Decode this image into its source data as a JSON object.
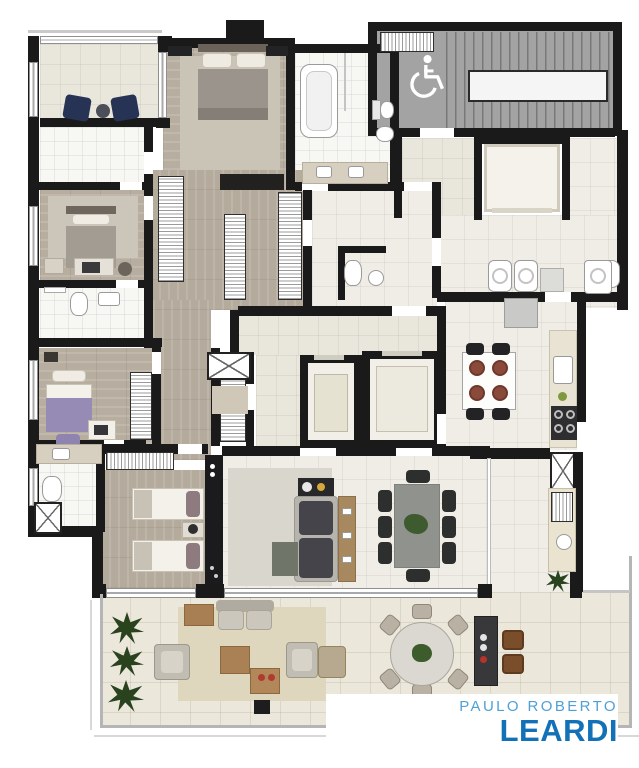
{
  "brand": {
    "name_line1": "PAULO ROBERTO",
    "name_line2": "LEARDI",
    "light_blue": "#4fa0d5",
    "dark_blue": "#1371b8"
  },
  "plan": {
    "type": "apartment-floor-plan",
    "accessibility_icon": "wheelchair-icon",
    "palette": {
      "wall": "#1a1a1a",
      "wood_floor": "#b4ab9d",
      "tile_floor": "#efede6",
      "bath_tile": "#f7f7f4",
      "stair_gray": "#a3a3a3",
      "terrace_tile": "#ebe7da",
      "indoor_rug": "#d9d6ce",
      "terrace_rug": "#ded7bd",
      "accent_navy": "#273354",
      "accent_purple": "#968bb4",
      "plant_green": "#2a431f"
    },
    "rooms": [
      "balcony",
      "master-suite",
      "closet",
      "master-bathroom",
      "staircase",
      "service-elevator",
      "suite-2",
      "bathroom-2",
      "suite-3",
      "bathroom-3",
      "bedroom-4",
      "hallway",
      "entry-foyer",
      "elevators",
      "lavabo",
      "service-area",
      "kitchen",
      "living-room",
      "dining-area",
      "gourmet-terrace",
      "terrace"
    ],
    "furniture": [
      "double-bed",
      "single-beds",
      "wardrobes",
      "bathtub",
      "shower",
      "toilets",
      "sofa",
      "tv-panel",
      "dining-table-8-chairs",
      "breakfast-table",
      "cooktop",
      "fridge",
      "washers",
      "laundry-sink",
      "round-table-6-chairs",
      "grill-island",
      "outdoor-lounge",
      "plants"
    ]
  }
}
